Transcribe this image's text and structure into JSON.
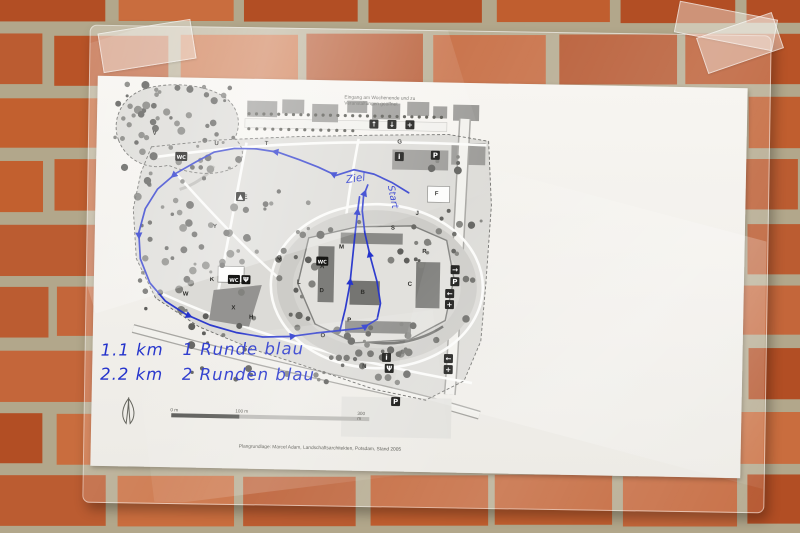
{
  "colors": {
    "brick": "#bf5e31",
    "mortar": "#b2a78b",
    "paper": "#f4f2ed",
    "route_blue": "#2433cc",
    "map_gray": "#dcdbd7"
  },
  "paper": {
    "notice_line1": "Eingang am Wochenende und zu",
    "notice_line2": "Veranstaltungen geöffnet",
    "attribution": "Plangrundlage: Marcel Adam, Landschaftsarchitekten, Potsdam, Stand 2005",
    "scale": {
      "t0": "0 m",
      "t1": "100 m",
      "t2": "300 m"
    },
    "handwriting": {
      "line1": "1.1 km   1 Runde blau",
      "line2": "2.2 km   2 Runden blau",
      "ziel": "Ziel",
      "start": "Start"
    }
  },
  "legend": {
    "headers": [
      {
        "de": "Park mit „botanischer Fülle“",
        "en": "Park with „botanical abundance“"
      },
      {
        "de": "Park mit „Landschaften von Welt“",
        "en": "Park with „landscapes of the world“"
      }
    ],
    "items": [
      {
        "k": "A",
        "de": "Schloss Moritzburg",
        "en": "Castle Moritzburg"
      },
      {
        "k": "B",
        "de": "Dom Sankt Peter und Paul",
        "en": "Cathedral Saint Peter and Paul"
      },
      {
        "k": "C",
        "de": "Torhaus",
        "en": "Gatehouse"
      },
      {
        "k": "D",
        "de": "Brückenhaus",
        "en": "Bridge house"
      },
      {
        "k": "E",
        "de": "Badehaus",
        "en": "Bath house"
      },
      {
        "k": "F",
        "de": "Japanischer Garten",
        "en": "Japanese garden"
      },
      {
        "k": "G",
        "de": "Bastionsplatz",
        "en": "Bastion square"
      },
      {
        "k": "H",
        "de": "Otterteich",
        "en": "Otter pond"
      },
      {
        "k": "I",
        "de": "Dehmelder Garten",
        "en": "Dehmelder garden"
      },
      {
        "k": "J",
        "de": "Rosengarten",
        "en": "Rose garden"
      },
      {
        "k": "K",
        "de": "Baumschule",
        "en": "Tree nursery"
      },
      {
        "k": "L",
        "de": "Orangerie",
        "en": "Orangery"
      },
      {
        "k": "M",
        "de": "Schlossküchengarten",
        "en": "Castle kitchen garden"
      },
      {
        "k": "N",
        "de": "Nachwachsende Rohstoffe",
        "en": "Renewable raw materials"
      },
      {
        "k": "O",
        "de": "Obstgarten und Bienenhaus",
        "en": "Orchard and bee house"
      },
      {
        "k": "P",
        "de": "Heilpflanzen und Apothekergarten",
        "en": "Medicinal plant garden"
      },
      {
        "k": "Q",
        "de": "Schlosspark",
        "en": "Castle park"
      },
      {
        "k": "R",
        "de": "Wallgraben",
        "en": "Rampart moat"
      },
      {
        "k": "S",
        "de": "Lustgarten",
        "en": "Pleasure garden"
      },
      {
        "k": "T",
        "de": "Grünes Klassenzimmer",
        "en": "Green classroom"
      },
      {
        "k": "U",
        "de": "Menagerie",
        "en": "Menagerie"
      },
      {
        "k": "V",
        "de": "Brossener Park",
        "en": "Brossener park"
      },
      {
        "k": "W",
        "de": "Wasserkreuzbrücke",
        "en": "Water cross bridge"
      },
      {
        "k": "X",
        "de": "Bühne",
        "en": "Stage"
      },
      {
        "k": "Y",
        "de": "Johannisteich",
        "en": "Johannis pond"
      }
    ],
    "symbols": [
      {
        "icon": "entrance",
        "de": "Eingang",
        "en": "Entrance"
      },
      {
        "icon": "parking",
        "de": "Parkplatz",
        "en": "Car park"
      },
      {
        "icon": "first-aid",
        "de": "Erste Hilfe",
        "en": "First aid"
      },
      {
        "icon": "information",
        "de": "Information",
        "en": "Information"
      },
      {
        "icon": "toilets",
        "de": "Toilette",
        "en": "Toilettes"
      },
      {
        "icon": "playground",
        "de": "Spielplatz",
        "en": "Playground"
      },
      {
        "icon": "bus-stop",
        "de": "Haltestelle",
        "en": "Bus stop"
      },
      {
        "icon": "restaurant",
        "de": "Gastronomie",
        "en": "Restaurant"
      },
      {
        "icon": "boundary",
        "de": "Parkgrenze",
        "en": "Park boundaries"
      }
    ]
  },
  "map": {
    "letters": [
      {
        "t": "U",
        "x": 120,
        "y": 67
      },
      {
        "t": "T",
        "x": 170,
        "y": 66
      },
      {
        "t": "Y",
        "x": 120,
        "y": 150
      },
      {
        "t": "Q",
        "x": 185,
        "y": 180
      },
      {
        "t": "S",
        "x": 298,
        "y": 148
      },
      {
        "t": "F",
        "x": 341,
        "y": 113
      },
      {
        "t": "A",
        "x": 228,
        "y": 188
      },
      {
        "t": "B",
        "x": 269,
        "y": 213
      },
      {
        "t": "C",
        "x": 316,
        "y": 204
      },
      {
        "t": "L",
        "x": 205,
        "y": 204
      },
      {
        "t": "X",
        "x": 140,
        "y": 231
      },
      {
        "t": "W",
        "x": 92,
        "y": 218
      },
      {
        "t": "H",
        "x": 158,
        "y": 240
      },
      {
        "t": "O",
        "x": 230,
        "y": 257
      },
      {
        "t": "N",
        "x": 272,
        "y": 287
      },
      {
        "t": "P",
        "x": 256,
        "y": 241
      },
      {
        "t": "R",
        "x": 330,
        "y": 171
      },
      {
        "t": "M",
        "x": 247,
        "y": 168
      },
      {
        "t": "G",
        "x": 303,
        "y": 62
      },
      {
        "t": "J",
        "x": 322,
        "y": 133
      },
      {
        "t": "E",
        "x": 150,
        "y": 120
      },
      {
        "t": "K",
        "x": 118,
        "y": 203
      },
      {
        "t": "D",
        "x": 228,
        "y": 212
      },
      {
        "t": "V",
        "x": 58,
        "y": 58
      }
    ],
    "icons": [
      {
        "t": "arrow-up",
        "x": 277,
        "y": 43
      },
      {
        "t": "arrow-down",
        "x": 295,
        "y": 43
      },
      {
        "t": "first-aid",
        "x": 313,
        "y": 43
      },
      {
        "t": "info",
        "x": 303,
        "y": 75
      },
      {
        "t": "parking",
        "x": 339,
        "y": 73
      },
      {
        "t": "arrow-right",
        "x": 361,
        "y": 187
      },
      {
        "t": "parking",
        "x": 361,
        "y": 199
      },
      {
        "t": "arrow-left",
        "x": 356,
        "y": 211
      },
      {
        "t": "first-aid",
        "x": 356,
        "y": 222
      },
      {
        "t": "arrow-left",
        "x": 356,
        "y": 276
      },
      {
        "t": "first-aid",
        "x": 356,
        "y": 287
      },
      {
        "t": "toilets",
        "x": 228,
        "y": 181
      },
      {
        "t": "toilets",
        "x": 85,
        "y": 79
      },
      {
        "t": "playground",
        "x": 145,
        "y": 118
      },
      {
        "t": "toilets",
        "x": 140,
        "y": 201
      },
      {
        "t": "restaurant",
        "x": 152,
        "y": 201
      },
      {
        "t": "parking",
        "x": 304,
        "y": 320
      },
      {
        "t": "info",
        "x": 294,
        "y": 276
      },
      {
        "t": "restaurant",
        "x": 297,
        "y": 287
      }
    ]
  }
}
